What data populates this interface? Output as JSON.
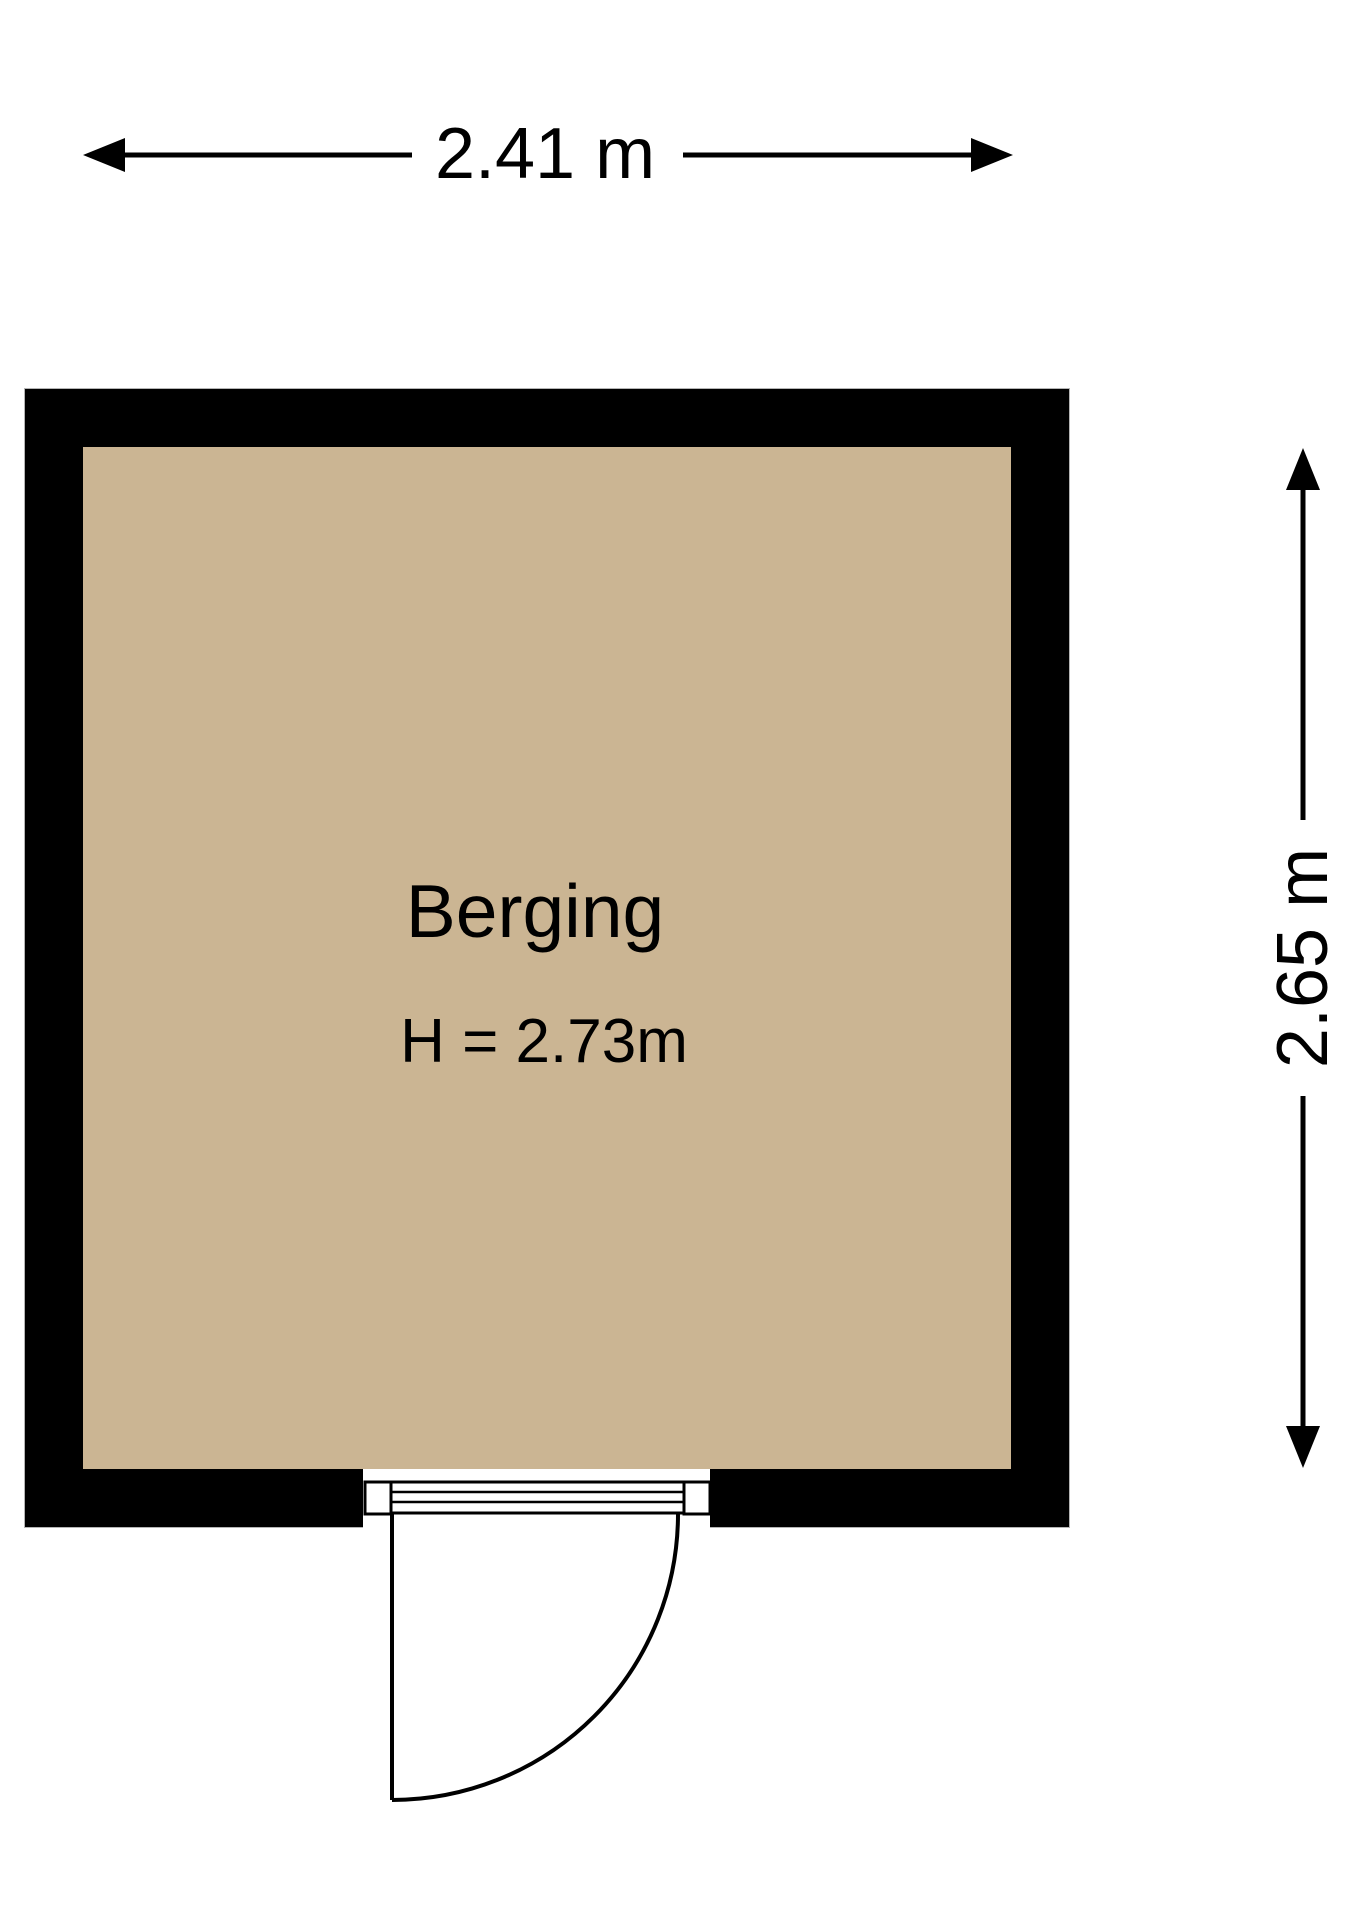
{
  "plan": {
    "room": {
      "name": "Berging",
      "ceiling_height": "H = 2.73m"
    },
    "dimensions": {
      "width": "2.41 m",
      "height": "2.65 m"
    },
    "colors": {
      "floor": "#cbb593",
      "wall": "#000000",
      "lines": "#000000",
      "background": "#ffffff"
    }
  }
}
